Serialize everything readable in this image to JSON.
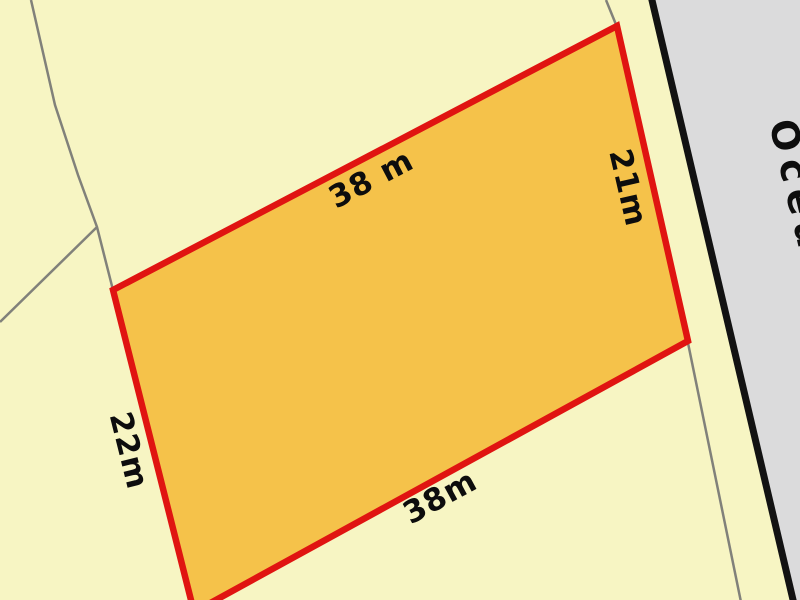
{
  "map": {
    "type": "cadastral-parcel-map",
    "colors": {
      "land_fill": "#F7F5C3",
      "parcel_fill": "#F5C24A",
      "parcel_outline": "#E01411",
      "road_fill": "#DBDBDC",
      "road_edge": "#121212",
      "boundary_line": "#81817A",
      "label_text": "#0D0D0D"
    },
    "parcel": {
      "dimension_labels": {
        "top": "38 m",
        "right": "21m",
        "left": "22m",
        "bottom": "38m"
      }
    },
    "road": {
      "name_visible": "Ocea"
    }
  }
}
